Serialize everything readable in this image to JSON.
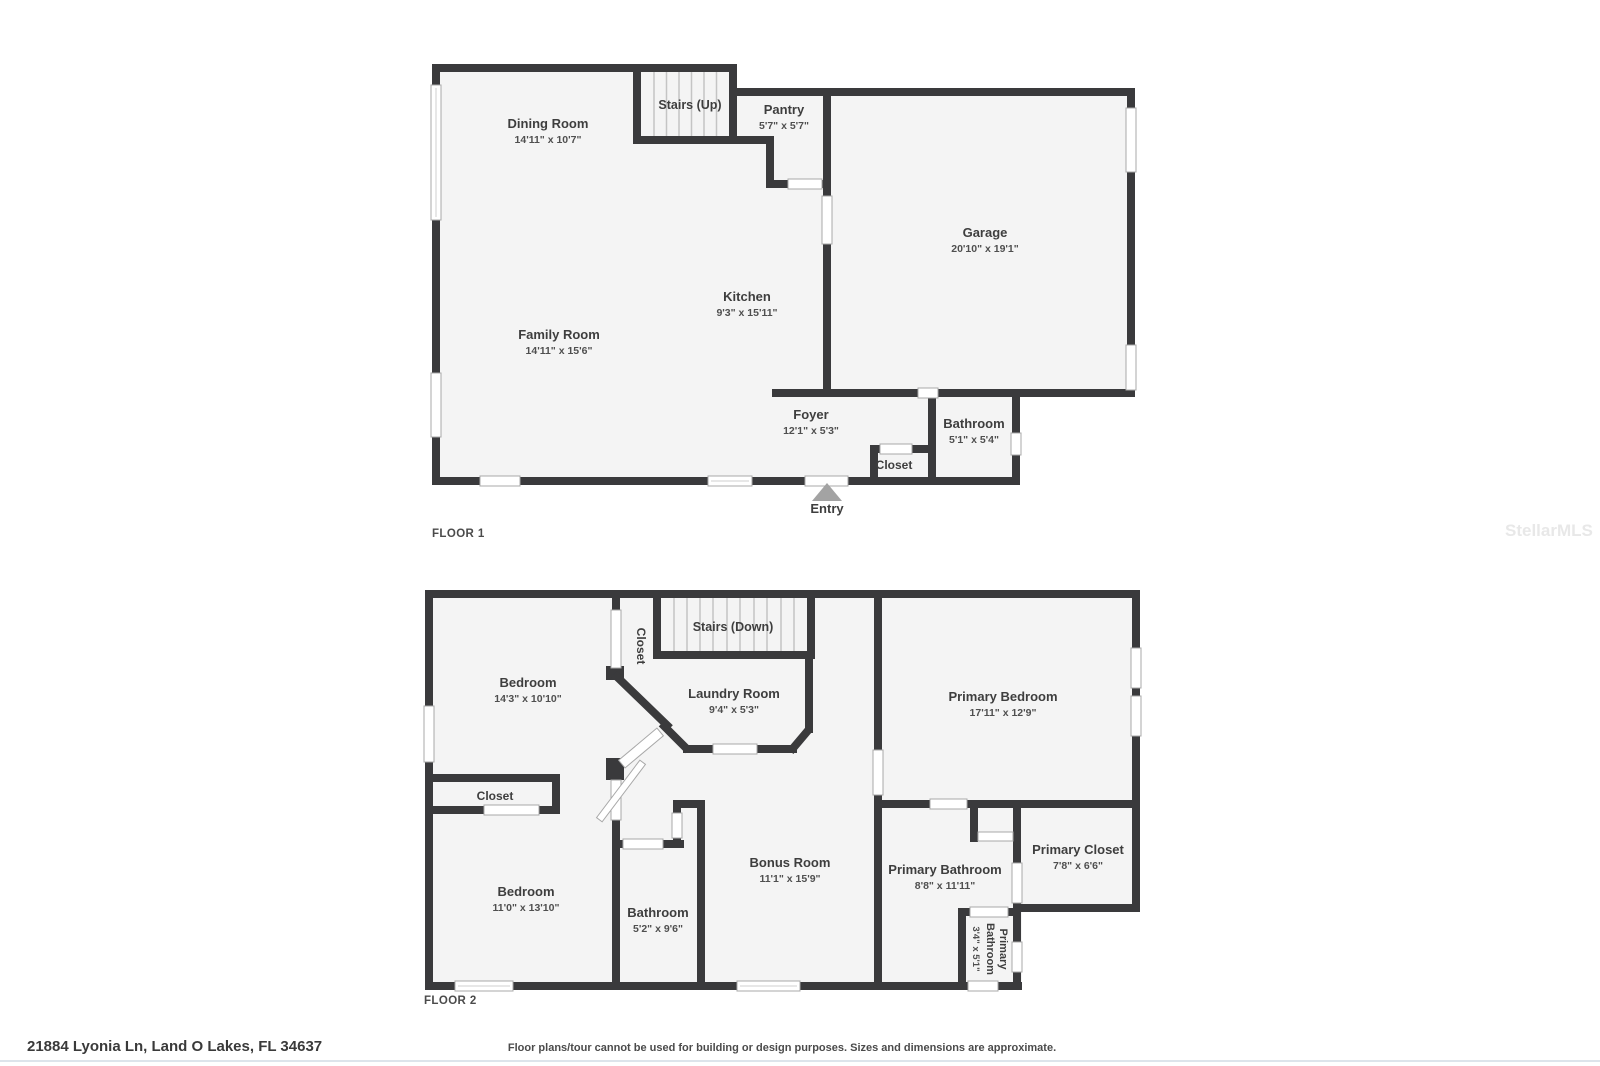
{
  "watermark": "StellarMLS",
  "footer": {
    "address": "21884 Lyonia Ln, Land O Lakes, FL 34637",
    "disclaimer": "Floor plans/tour cannot be used for building or design purposes. Sizes and dimensions are approximate."
  },
  "colors": {
    "wall": "#3a3a3c",
    "room_fill": "#f4f4f4"
  },
  "floor1": {
    "label": "FLOOR 1",
    "entry": "Entry",
    "rooms": {
      "dining": {
        "name": "Dining Room",
        "dims": "14'11\" x 10'7\""
      },
      "stairs": {
        "name": "Stairs (Up)"
      },
      "pantry": {
        "name": "Pantry",
        "dims": "5'7\" x 5'7\""
      },
      "garage": {
        "name": "Garage",
        "dims": "20'10\" x 19'1\""
      },
      "kitchen": {
        "name": "Kitchen",
        "dims": "9'3\" x 15'11\""
      },
      "family": {
        "name": "Family Room",
        "dims": "14'11\" x 15'6\""
      },
      "foyer": {
        "name": "Foyer",
        "dims": "12'1\" x 5'3\""
      },
      "closet": {
        "name": "Closet"
      },
      "bathroom": {
        "name": "Bathroom",
        "dims": "5'1\" x 5'4\""
      }
    }
  },
  "floor2": {
    "label": "FLOOR 2",
    "rooms": {
      "bedroom1": {
        "name": "Bedroom",
        "dims": "14'3\" x 10'10\""
      },
      "hall_closet": {
        "name": "Closet"
      },
      "stairs": {
        "name": "Stairs (Down)"
      },
      "laundry": {
        "name": "Laundry Room",
        "dims": "9'4\" x 5'3\""
      },
      "primary_bedroom": {
        "name": "Primary Bedroom",
        "dims": "17'11\" x 12'9\""
      },
      "closet": {
        "name": "Closet"
      },
      "bedroom2": {
        "name": "Bedroom",
        "dims": "11'0\" x 13'10\""
      },
      "bathroom": {
        "name": "Bathroom",
        "dims": "5'2\" x 9'6\""
      },
      "bonus": {
        "name": "Bonus Room",
        "dims": "11'1\" x 15'9\""
      },
      "primary_bathroom": {
        "name": "Primary Bathroom",
        "dims": "8'8\" x 11'11\""
      },
      "primary_closet": {
        "name": "Primary Closet",
        "dims": "7'8\" x 6'6\""
      },
      "primary_wc": {
        "name": "Primary Bathroom",
        "name_line1": "Primary",
        "name_line2": "Bathroom",
        "dims": "3'4\" x 5'1\""
      }
    }
  }
}
